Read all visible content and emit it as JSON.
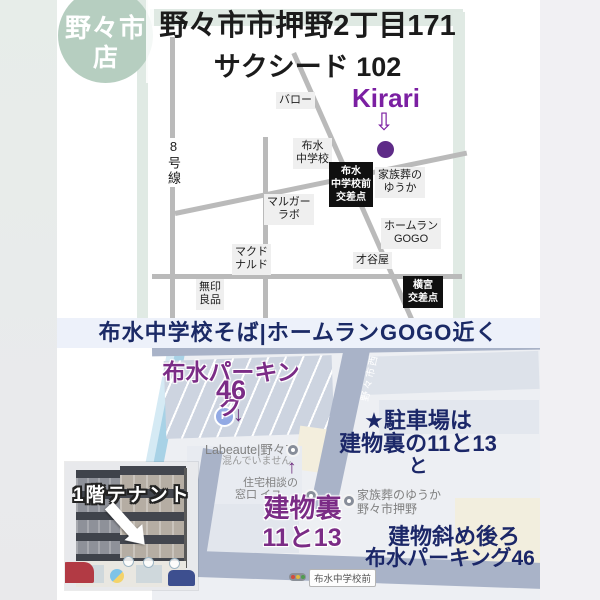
{
  "badge": {
    "line1": "野々市",
    "line2": "店"
  },
  "header": {
    "address": "野々市市押野2丁目171",
    "building": "サクシード 102"
  },
  "sketch_map": {
    "route8": "8号線",
    "shop_name": "Kirari",
    "shop_arrow": "⇩",
    "labels": {
      "valor": "バロー",
      "fusui_jhs": "布水\n中学校",
      "margar_labo": "マルガー\nラボ",
      "mcdonalds": "マクド\nナルド",
      "muji": "無印\n良品",
      "saitaniya": "才谷屋",
      "homerun_gogo": "ホームラン\nGOGO",
      "kazokuso_yuka": "家族葬の\nゆうか"
    },
    "intersections": {
      "fusui_front": "布水\n中学校前\n交差点",
      "yokomiya": "横宮\n交差点"
    }
  },
  "banner": {
    "text": "布水中学校そば|ホームランGOGO近く"
  },
  "detail_map": {
    "parking_name": "布水パーキング",
    "parking_number": "46",
    "p_icon": "P",
    "down_arrow": "↓",
    "up_arrow": "↑",
    "labeaute": "Labeaute|野々市",
    "crowd_status": "混んでいません",
    "road_name": "野々市西",
    "parking_note": {
      "line1": "★駐車場は",
      "line2": "建物裏の11と13",
      "line3": "と"
    },
    "jutaku": {
      "line1": "住宅相談の",
      "line2": "窓口 イユ"
    },
    "building_back": "建物裏",
    "building_back_numbers": "11と13",
    "kazokuso": {
      "line1": "家族葬のゆうか",
      "line2": "野々市押野"
    },
    "location_note": {
      "line1": "建物斜め後ろ",
      "line2": "布水パーキング46"
    },
    "bus_stop": "布水中学校前"
  },
  "photo": {
    "caption": "1階テナント"
  },
  "colors": {
    "accent_purple": "#7b1fa2",
    "map_purple": "#7b2c86",
    "navy": "#1b2768",
    "sage": "#b6cec0",
    "banner_bg": "#edf1fa"
  }
}
